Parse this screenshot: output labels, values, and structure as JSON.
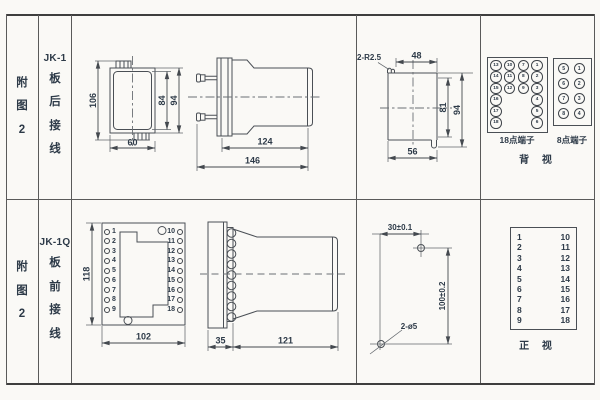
{
  "colors": {
    "line": "#4a4f55",
    "text": "#2d3a48",
    "border": "#5a5a5a",
    "background": "#faf9f6"
  },
  "row_top": {
    "fig_chars": [
      "附",
      "图",
      "2"
    ],
    "model": "JK-1",
    "wiring_chars": [
      "板",
      "后",
      "接",
      "线"
    ],
    "rear_view": {
      "h_total": "106",
      "h_inner": "84",
      "h_outer": "94",
      "w": "60"
    },
    "side_view": {
      "body": "124",
      "total": "146"
    },
    "cutout": {
      "note": "2-R2.5",
      "top": "48",
      "inner_h": "81",
      "outer_h": "94",
      "bottom": "56"
    },
    "terminals": {
      "t18": {
        "label": "18点端子",
        "cells": [
          "13",
          "10",
          "7",
          "1",
          "14",
          "11",
          "8",
          "2",
          "15",
          "12",
          "9",
          "3",
          "16",
          "",
          "",
          "4",
          "17",
          "",
          "",
          "5",
          "18",
          "",
          "",
          "6"
        ]
      },
      "t8": {
        "label": "8点端子",
        "cells": [
          "5",
          "1",
          "6",
          "2",
          "7",
          "3",
          "8",
          "4"
        ]
      },
      "view_label": "背 视"
    }
  },
  "row_bottom": {
    "fig_chars": [
      "附",
      "图",
      "2"
    ],
    "model": "JK-1Q",
    "wiring_chars": [
      "板",
      "前",
      "接",
      "线"
    ],
    "front_view": {
      "h": "118",
      "w": "102",
      "left_terminals": [
        "1",
        "2",
        "3",
        "4",
        "5",
        "6",
        "7",
        "8",
        "9"
      ],
      "right_terminals": [
        "10",
        "11",
        "12",
        "13",
        "14",
        "15",
        "16",
        "17",
        "18"
      ]
    },
    "side_view": {
      "plate": "35",
      "body": "121"
    },
    "drill_plan": {
      "h_dim": "30±0.1",
      "v_dim": "100±0.2",
      "holes": "2-ø5"
    },
    "front_list": {
      "left": [
        "1",
        "2",
        "3",
        "4",
        "5",
        "6",
        "7",
        "8",
        "9"
      ],
      "right": [
        "10",
        "11",
        "12",
        "13",
        "14",
        "15",
        "16",
        "17",
        "18"
      ],
      "view_label": "正 视"
    }
  }
}
